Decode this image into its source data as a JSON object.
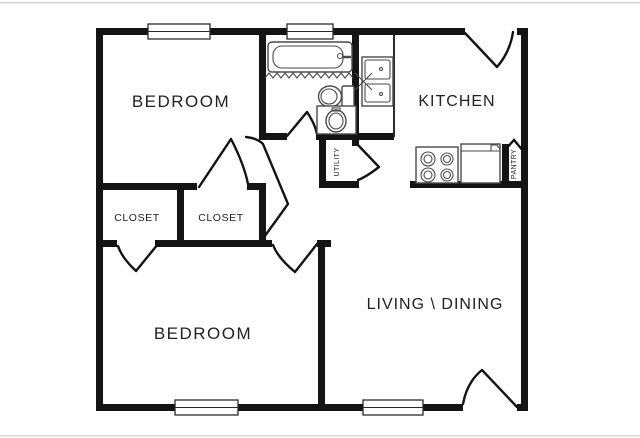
{
  "theme": {
    "background": "#ffffff",
    "wall": "#141414",
    "door": "#141414",
    "fixture": "#4a4a4a",
    "label": "#222222",
    "window_border": "#2a2a2a",
    "edge_line": "#d4d4d4"
  },
  "plan_title": "2 Bedroom 1 Bath Floor Plan",
  "rooms": {
    "bedroom_top": {
      "label": "BEDROOM"
    },
    "bedroom_bottom": {
      "label": "BEDROOM"
    },
    "kitchen": {
      "label": "KITCHEN"
    },
    "living_dining": {
      "label": "LIVING \\ DINING"
    },
    "closet_left": {
      "label": "CLOSET"
    },
    "closet_right": {
      "label": "CLOSET"
    },
    "utility": {
      "label": "UTILITY"
    },
    "pantry": {
      "label": "PANTRY"
    }
  },
  "fixtures": {
    "bathtub": "bathtub-with-shower-curtain",
    "toilet": "toilet",
    "vanity_sink": "bathroom-vanity-sink",
    "kitchen_sink": "double-basin-kitchen-sink",
    "stove": "four-burner-stove",
    "refrigerator": "refrigerator"
  }
}
